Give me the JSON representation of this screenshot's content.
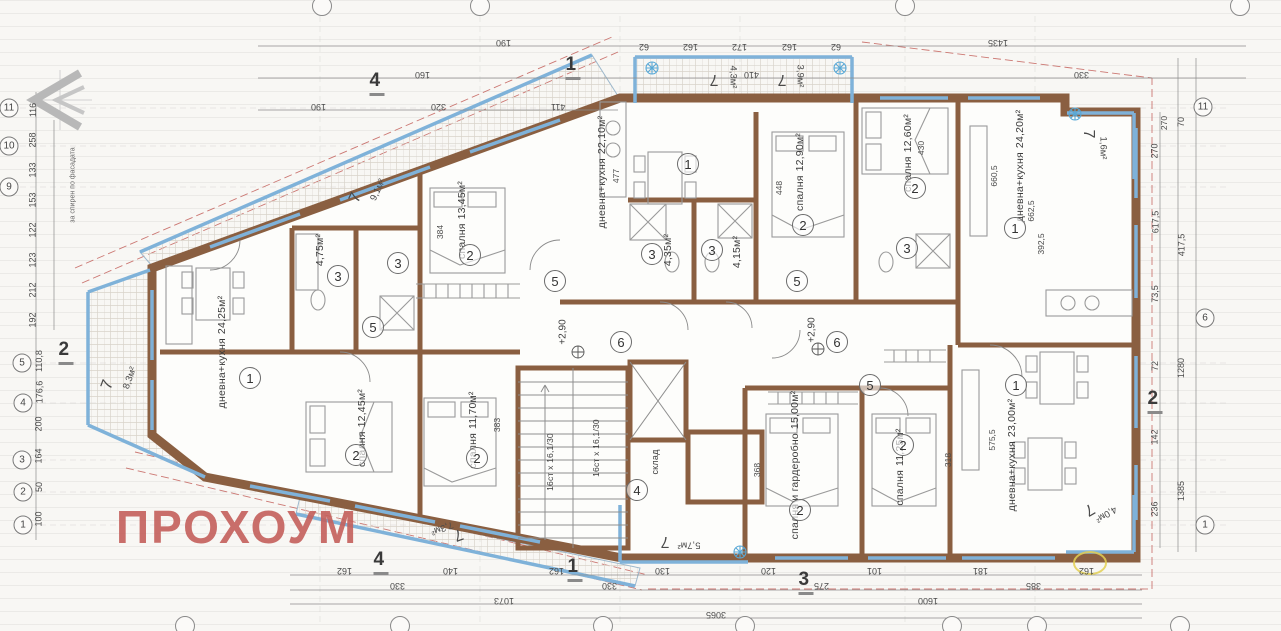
{
  "watermark": {
    "text": "ПРОХОУМ",
    "color": "#c4605c"
  },
  "side_note": "за спирен по фасадата",
  "levels": [
    "+2,90",
    "+2,90"
  ],
  "stair_flights": [
    "16ст x 16,1/30",
    "16ст x 16,1/30"
  ],
  "storage": {
    "number": "4",
    "label": "склад"
  },
  "rooms": [
    {
      "number": "1",
      "name": "дневна+кухня",
      "area": "24,25м²"
    },
    {
      "number": "2",
      "name": "спалня",
      "area": "13,45м²"
    },
    {
      "number": "1",
      "name": "дневна+кухня",
      "area": "22,10м²"
    },
    {
      "number": "2",
      "name": "спалня",
      "area": "12,90м²"
    },
    {
      "number": "2",
      "name": "спалня",
      "area": "12,60м²"
    },
    {
      "number": "1",
      "name": "дневна+кухня",
      "area": "24,20м²"
    },
    {
      "number": "2",
      "name": "спалня",
      "area": "12,45м²"
    },
    {
      "number": "2",
      "name": "спалня",
      "area": "11,70м²"
    },
    {
      "number": "2",
      "name": "спалня и гардеробно",
      "area": "15,00м²"
    },
    {
      "number": "2",
      "name": "спалня",
      "area": "11,25м²"
    },
    {
      "number": "1",
      "name": "дневна+кухня",
      "area": "23,00м²"
    }
  ],
  "bathrooms": [
    {
      "number": "3",
      "area": "4,75м²"
    },
    {
      "number": "3",
      "area": "4,35м²"
    },
    {
      "number": "3",
      "area": "4,15м²"
    }
  ],
  "extra_bath_numbers": [
    "3",
    "3"
  ],
  "corridor_numbers": [
    "5",
    "5",
    "5",
    "5"
  ],
  "hall_numbers": [
    "6",
    "6"
  ],
  "balconies": [
    {
      "number": "7",
      "area": "8,3м²"
    },
    {
      "number": "7",
      "area": "9,1м²"
    },
    {
      "number": "7",
      "area": "4,3м²"
    },
    {
      "number": "7",
      "area": "3,9м²"
    },
    {
      "number": "7",
      "area": "1,6м²"
    },
    {
      "number": "7",
      "area": "7,3м²"
    },
    {
      "number": "7",
      "area": "5,7м²"
    },
    {
      "number": "7",
      "area": "4,0м²"
    }
  ],
  "section_marks": [
    "4",
    "1",
    "2",
    "2",
    "4",
    "1",
    "3"
  ],
  "grid_axes": {
    "left": [
      "11",
      "10",
      "9",
      "5",
      "4",
      "3",
      "2",
      "1"
    ],
    "right": [
      "11",
      "6",
      "1"
    ]
  },
  "dims": {
    "top_row1": [
      "190",
      "1435"
    ],
    "top_row2": [
      "160",
      "410",
      "330"
    ],
    "top_row3": [
      "190",
      "320",
      "411"
    ],
    "top_row4": [
      "62",
      "162",
      "172",
      "162",
      "62"
    ],
    "bottom_row1": [
      "162",
      "140",
      "162",
      "130",
      "120",
      "101",
      "181",
      "162"
    ],
    "bottom_row2": [
      "330",
      "330",
      "275",
      "385"
    ],
    "bottom_row3": [
      "1073",
      "1600"
    ],
    "bottom_row4": [
      "3065"
    ],
    "left_upper": [
      "116",
      "258",
      "133",
      "153",
      "122",
      "123",
      "212",
      "192"
    ],
    "left_lower": [
      "110,8",
      "176,6",
      "200",
      "164",
      "50",
      "100"
    ],
    "right_inner": [
      "270",
      "617,5",
      "73,5",
      "72",
      "142",
      "236"
    ],
    "right_outer": [
      "70",
      "417,5",
      "1280",
      "1385"
    ],
    "inner": [
      "477",
      "430",
      "448",
      "384",
      "383",
      "368",
      "318",
      "660,5",
      "662,5",
      "392,5",
      "575,5",
      "270"
    ]
  }
}
